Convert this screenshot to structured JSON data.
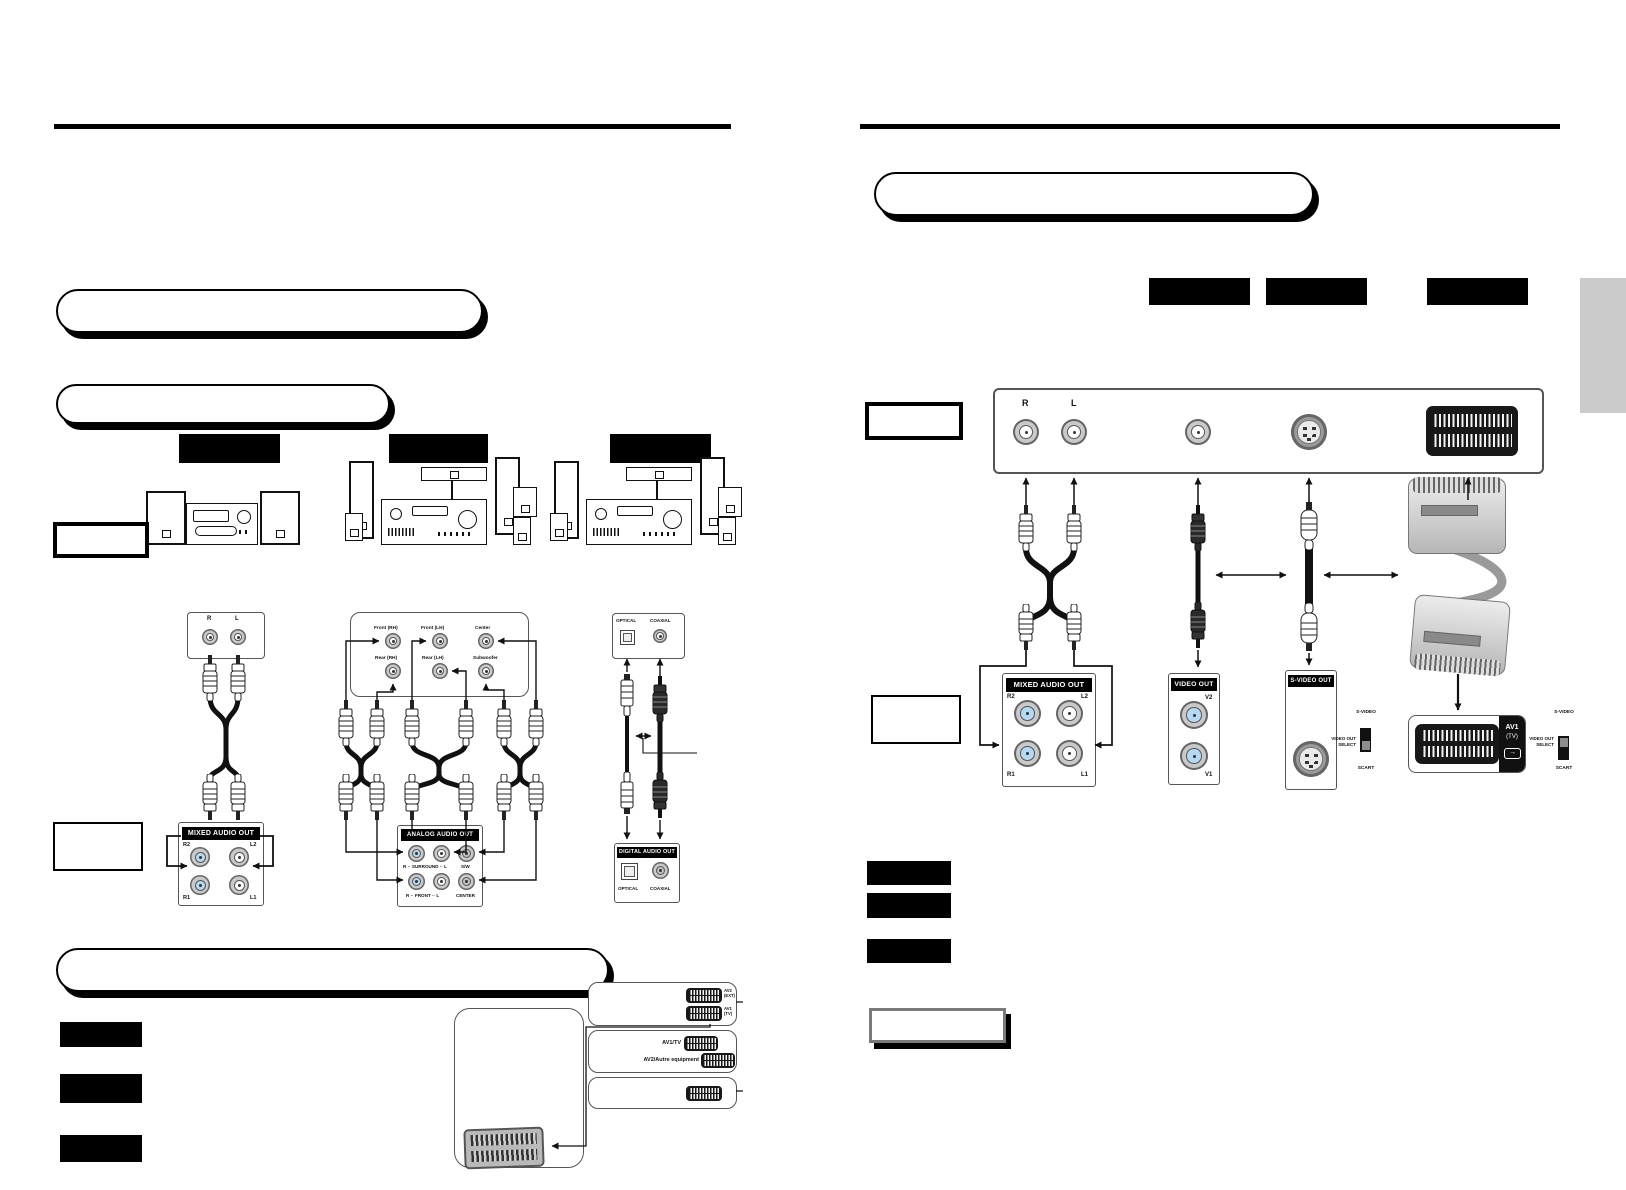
{
  "left_page": {
    "stereo": {
      "source_r": "R",
      "source_l": "L",
      "panel": {
        "title": "MIXED AUDIO OUT",
        "r2": "R2",
        "l2": "L2",
        "r1": "R1",
        "l1": "L1"
      }
    },
    "surround": {
      "amp": {
        "front_rh": "Front (RH)",
        "front_lh": "Front (LH)",
        "center": "Center",
        "rear_rh": "Rear (RH)",
        "rear_lh": "Rear (LH)",
        "subwoofer": "Subwoofer"
      },
      "panel": {
        "title": "ANALOG AUDIO OUT",
        "surround_row": "R ·· SURROUND ·· L",
        "sw": "S/W",
        "front_row": "R ·· FRONT ·· L",
        "center": "CENTER"
      }
    },
    "digital": {
      "source_optical": "OPTICAL",
      "source_coaxial": "COAXIAL",
      "panel": {
        "title": "DIGITAL AUDIO OUT",
        "optical": "OPTICAL",
        "coaxial": "COAXIAL"
      }
    },
    "scart_panel_labels": {
      "av2_ext": "AV2 (EXT)",
      "av1_tv": "AV1 (TV)",
      "av1_tv_slash": "AV1/TV",
      "av2_other": "AV2/Autre equipment"
    }
  },
  "right_page": {
    "rear_panel": {
      "r": "R",
      "l": "L"
    },
    "mixed_audio_out": {
      "title": "MIXED AUDIO OUT",
      "r2": "R2",
      "l2": "L2",
      "r1": "R1",
      "l1": "L1"
    },
    "video_out": {
      "title": "VIDEO OUT",
      "v2": "V2",
      "v1": "V1"
    },
    "s_video_out": {
      "title": "S-VIDEO OUT"
    },
    "av1_panel": {
      "name": "AV1",
      "sub": "(TV)"
    },
    "switches": [
      {
        "top": "S-VIDEO",
        "label1": "VIDEO OUT",
        "label2": "SELECT",
        "bottom": "SCART",
        "position": "S-VIDEO"
      },
      {
        "top": "S-VIDEO",
        "label1": "VIDEO OUT",
        "label2": "SELECT",
        "bottom": "SCART",
        "position": "SCART"
      }
    ]
  },
  "colors": {
    "jack_blue": "#b5d9f2",
    "page_tab": "#cbcbcb",
    "redaction": "#000000"
  }
}
